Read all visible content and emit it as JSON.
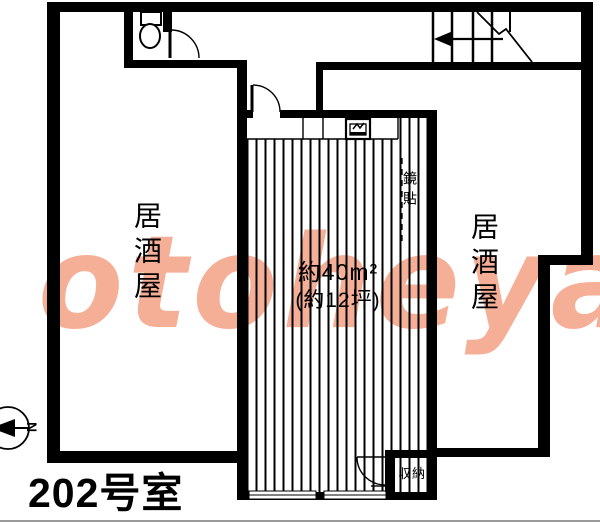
{
  "floorplan": {
    "room_title": "202号室",
    "unit": {
      "area": "約40m²",
      "area_tsubo": "(約12坪)",
      "mirror": "鏡貼",
      "storage": "収納"
    },
    "left_room": "居酒屋",
    "right_room": "居酒屋",
    "compass": {
      "north": "N"
    },
    "watermark": {
      "text": "otoheya",
      "color": "#f49e80"
    },
    "colors": {
      "wall": "#000000",
      "background": "#ffffff"
    }
  }
}
